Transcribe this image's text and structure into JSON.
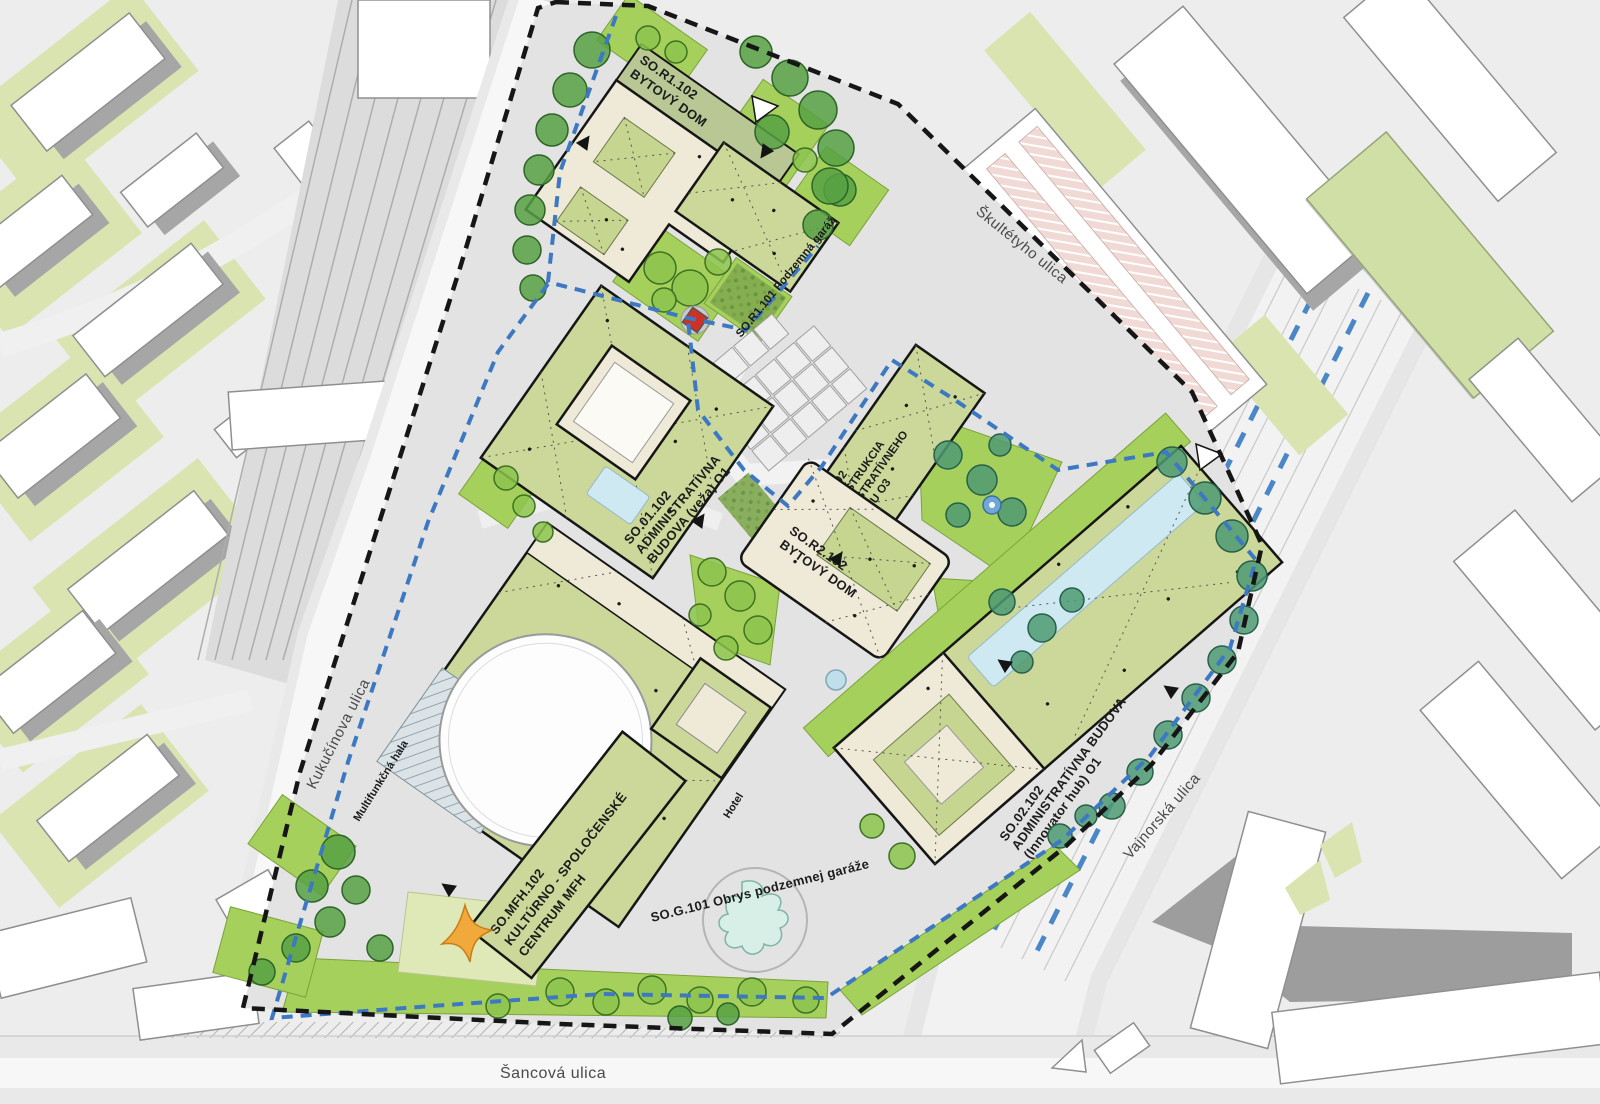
{
  "plan": {
    "streets": {
      "skultetyho": "Škultétyho ulica",
      "kukucinova": "Kukučínova ulica",
      "vajnorska": "Vajnorská ulica",
      "sancova": "Šancová ulica"
    },
    "objects": {
      "r1": {
        "lines": [
          "SO.R1.102",
          "BYTOVÝ DOM"
        ]
      },
      "r1_garage": {
        "label": "SO.R1.101  Podzemná garáž"
      },
      "o1": {
        "lines": [
          "SO.01.102",
          "ADMINISTRATÍVNA",
          "BUDOVA (veža) O1"
        ]
      },
      "o3": {
        "lines": [
          "SO.03.102",
          "REKONŠTRUKCIA",
          "ADMINISTRATÍVNEHO",
          "OBJEKTU O3"
        ]
      },
      "r2": {
        "lines": [
          "SO.R2.102",
          "BYTOVÝ DOM"
        ]
      },
      "o2": {
        "lines": [
          "SO.02.102",
          "ADMINISTRATÍVNA BUDOVA",
          "(Innovator hub) O1"
        ]
      },
      "mfh": {
        "lines": [
          "SO.MFH.102",
          "KULTÚRNO - SPOLOČENSKÉ",
          "CENTRUM MFH"
        ]
      },
      "hala": {
        "label": "Multifunkčná hala"
      },
      "hotel": {
        "label": "Hotel"
      },
      "garage": {
        "label": "SO.G.101 Obrys podzemnej garáže"
      }
    },
    "colors": {
      "site_boundary": "#1a1a1a",
      "underground_garage_outline": "#3d78c2",
      "roof_green": "#cbd89a",
      "roof_cream": "#efe9d7",
      "lawn_green": "#a6d05c",
      "context_green": "#d9e4b0",
      "parking_pink": "#f1dad6",
      "pool_blue": "#cfe9f2",
      "marker_red": "#cf3126",
      "star_orange": "#f2a93b",
      "water_feature_teal": "#d8efe8"
    }
  }
}
